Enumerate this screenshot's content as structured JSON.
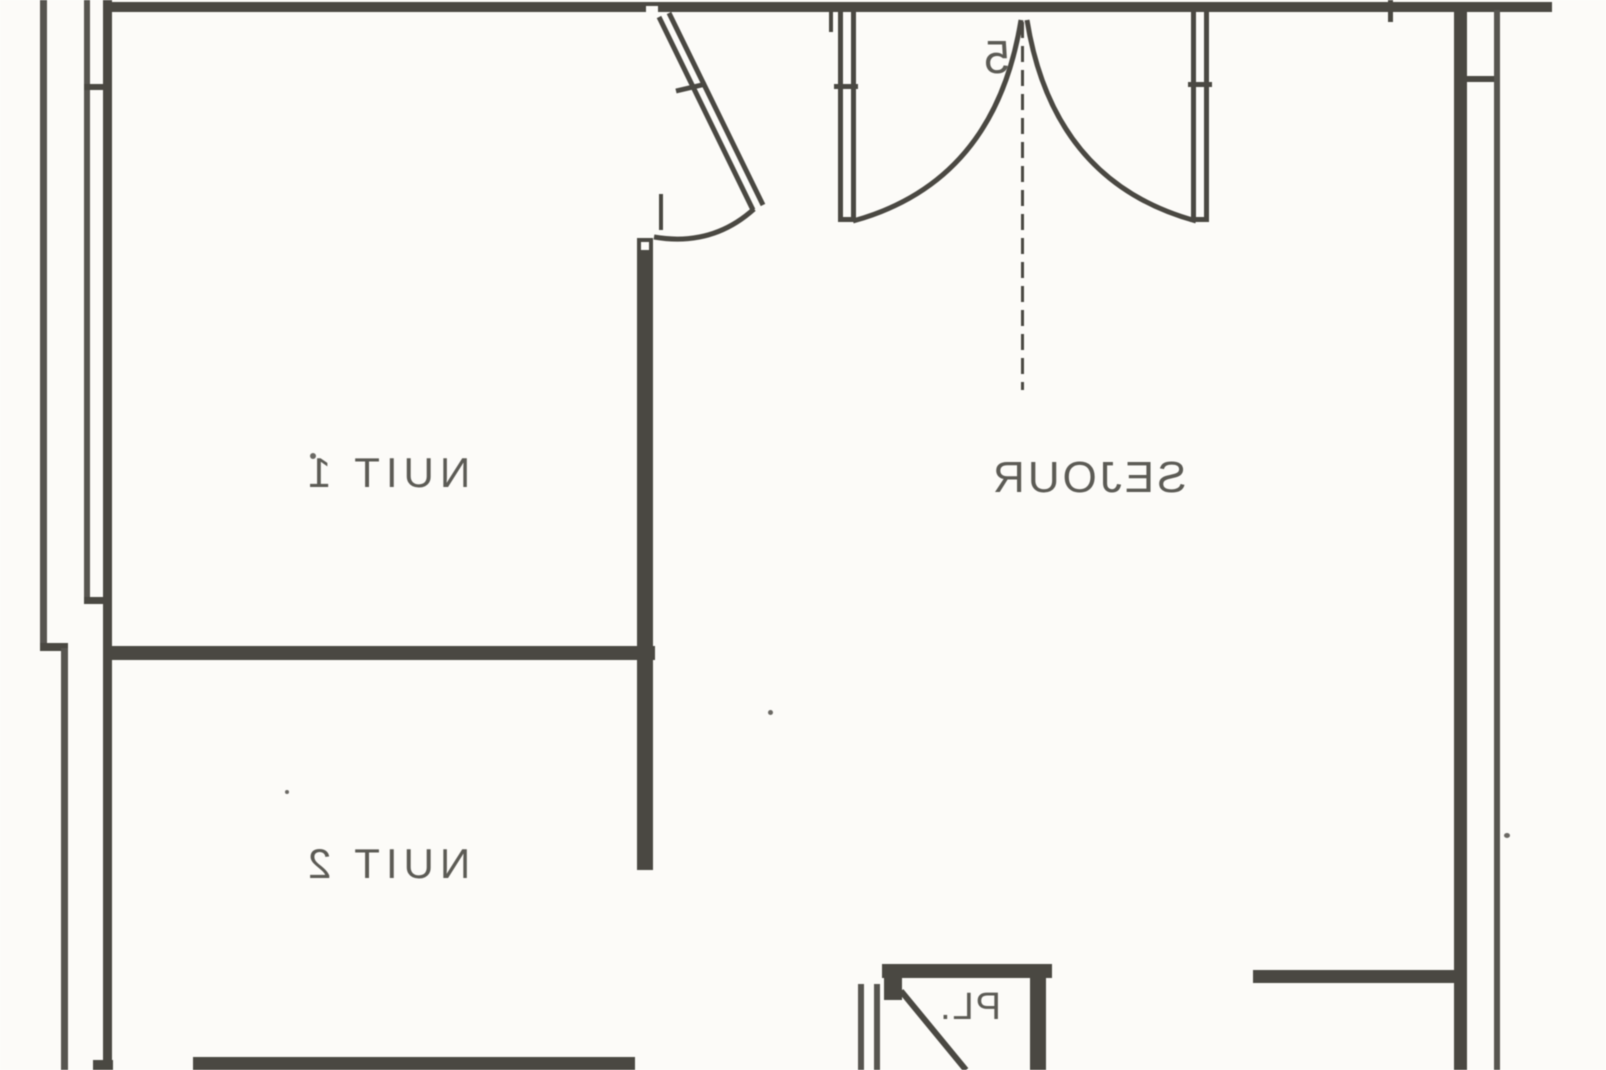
{
  "document": {
    "kind": "scanned architectural floor plan",
    "mirrored": true
  },
  "colors": {
    "paper": "#fcfbf8",
    "ink": "#4a4842"
  },
  "floor_plan": {
    "rooms": [
      {
        "id": "nuit-1",
        "label": "NUIT 1"
      },
      {
        "id": "nuit-2",
        "label": "NUIT 2"
      },
      {
        "id": "sejour",
        "label": "SEJOUR"
      },
      {
        "id": "placard",
        "label": "PL."
      }
    ],
    "annotations": [
      {
        "id": "door-mark",
        "label": "5"
      }
    ]
  }
}
